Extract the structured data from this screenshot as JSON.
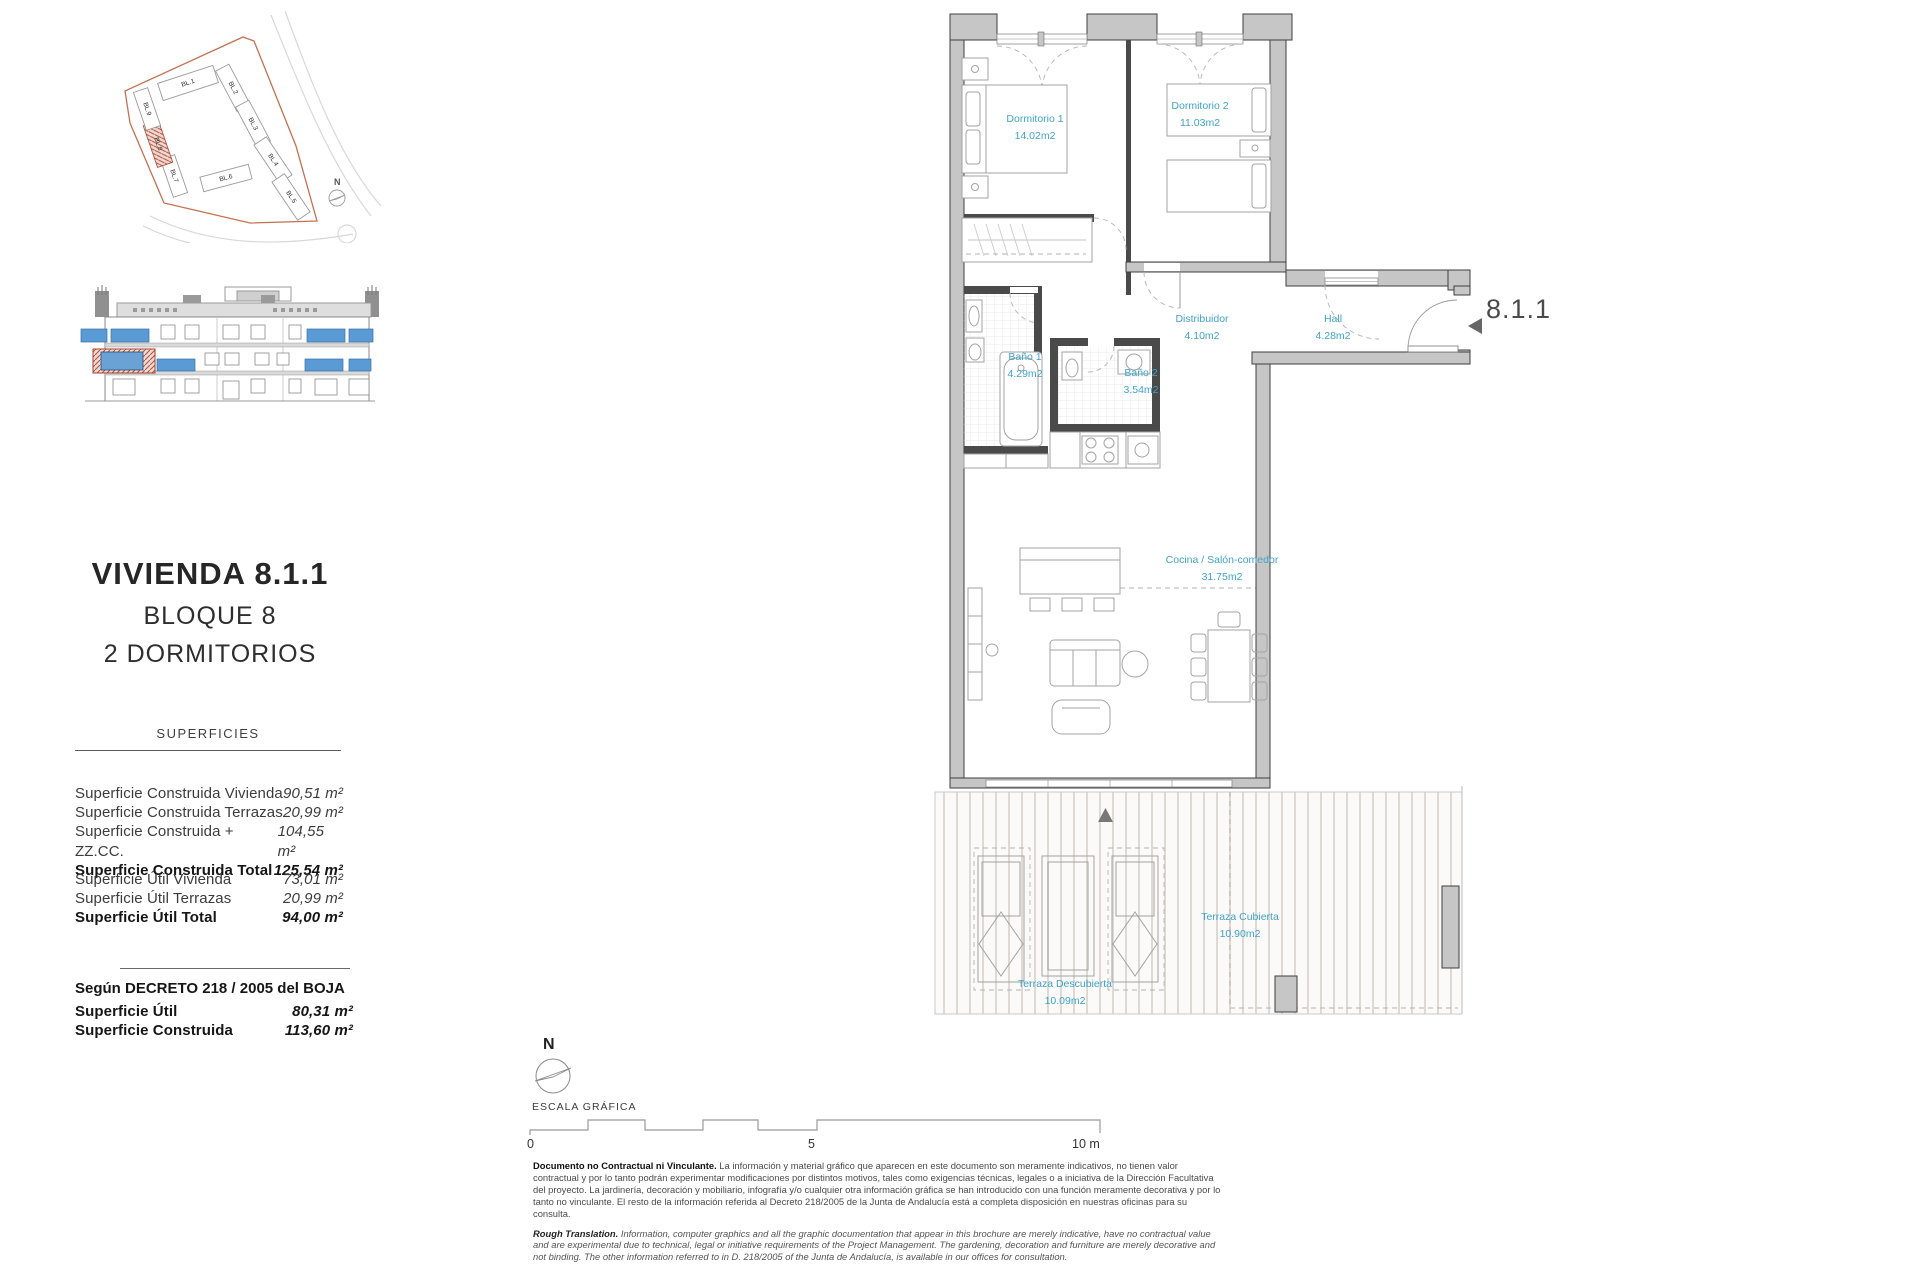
{
  "site_plan": {
    "blocks": [
      "BL.1",
      "BL.2",
      "BL.3",
      "BL.4",
      "BL.5",
      "BL.6",
      "BL.7",
      "BL.8",
      "BL.9"
    ],
    "highlighted_block": "BL.8",
    "north_label": "N",
    "boundary_color": "#c4704f",
    "highlight_color": "#b2543f"
  },
  "title_block": {
    "title": "VIVIENDA 8.1.1",
    "line2": "BLOQUE 8",
    "line3": "2 DORMITORIOS"
  },
  "superficies": {
    "heading": "SUPERFICIES",
    "construida_rows": [
      {
        "label": "Superficie Construida Vivienda",
        "value": "90,51 m²",
        "bold": false
      },
      {
        "label": "Superficie Construida Terrazas",
        "value": "20,99 m²",
        "bold": false
      },
      {
        "label": "Superficie Construida + ZZ.CC.",
        "value": "104,55 m²",
        "bold": false
      },
      {
        "label": "Superficie Construida Total",
        "value": "125,54 m²",
        "bold": true
      }
    ],
    "util_rows": [
      {
        "label": "Superficie Útil Vivienda",
        "value": "73,01 m²",
        "bold": false
      },
      {
        "label": "Superficie Útil Terrazas",
        "value": "20,99 m²",
        "bold": false
      },
      {
        "label": "Superficie Útil Total",
        "value": "94,00 m²",
        "bold": true
      }
    ]
  },
  "decreto": {
    "heading": "Según DECRETO 218 / 2005 del BOJA",
    "rows": [
      {
        "label": "Superficie Útil",
        "value": "80,31 m²",
        "bold": true
      },
      {
        "label": "Superficie Construida",
        "value": "113,60 m²",
        "bold": true
      }
    ]
  },
  "floor_plan": {
    "unit_label": "8.1.1",
    "label_color": "#3FA3C8",
    "rooms": [
      {
        "name": "Dormitorio 1",
        "area": "14.02m2"
      },
      {
        "name": "Dormitorio 2",
        "area": "11.03m2"
      },
      {
        "name": "Baño 1",
        "area": "4.29m2"
      },
      {
        "name": "Baño 2",
        "area": "3.54m2"
      },
      {
        "name": "Distribuidor",
        "area": "4.10m2"
      },
      {
        "name": "Hall",
        "area": "4.28m2"
      },
      {
        "name": "Cocina / Salón-comedor",
        "area": "31.75m2"
      },
      {
        "name": "Terraza Cubierta",
        "area": "10.90m2"
      },
      {
        "name": "Terraza Descubierta",
        "area": "10.09m2"
      }
    ]
  },
  "scale_block": {
    "north_label": "N",
    "escala_label": "ESCALA GRÁFICA",
    "tick_0": "0",
    "tick_5": "5",
    "tick_10": "10 m"
  },
  "disclaimer": {
    "es_lead": "Documento no Contractual ni Vinculante.",
    "es_text": " La información y material gráfico que aparecen en este documento son meramente indicativos, no tienen valor contractual y por lo tanto podrán experimentar modificaciones por distintos motivos, tales como exigencias técnicas, legales o a iniciativa de la Dirección Facultativa del proyecto. La jardinería, decoración y mobiliario, infografía y/o cualquier otra información gráfica se han introducido con una función meramente decorativa y por lo tanto no vinculante. El resto de la información referida al Decreto 218/2005 de la Junta de Andalucía está a completa disposición en nuestras oficinas para su consulta.",
    "en_lead": "Rough Translation.",
    "en_text": " Information, computer graphics and all the graphic documentation that appear in this brochure are merely indicative, have no contractual value and are experimental due to technical, legal or initiative requirements of the Project Management. The gardening, decoration and furniture are merely decorative and not binding. The other information referred to in D. 218/2005 of the Junta de Andalucía, is available in our offices for consultation."
  }
}
